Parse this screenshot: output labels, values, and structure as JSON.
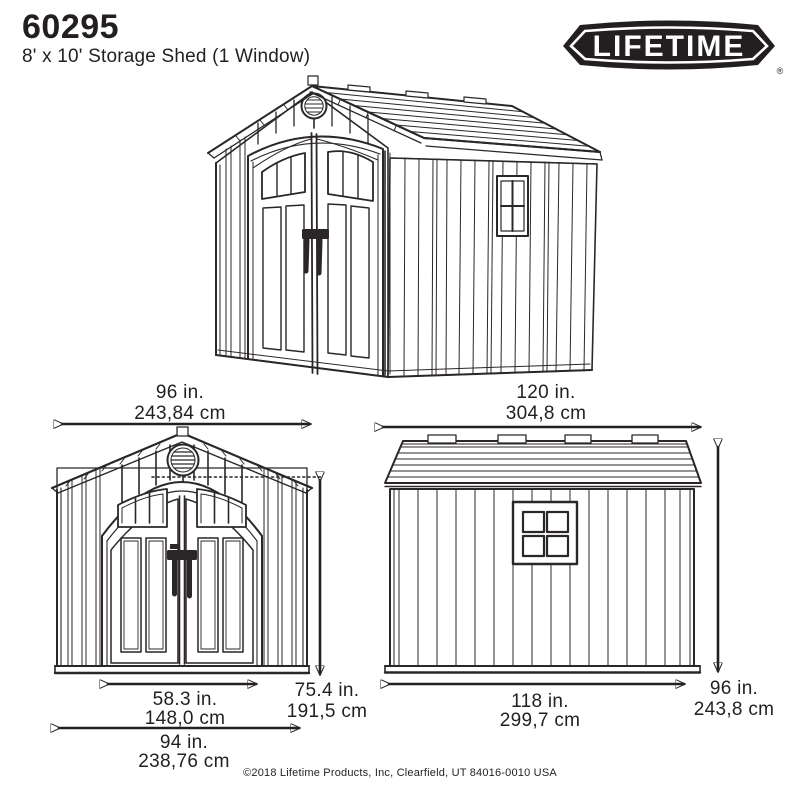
{
  "header": {
    "model": "60295",
    "subtitle": "8' x 10' Storage Shed (1 Window)"
  },
  "logo": {
    "text": "LIFETIME",
    "registered": "®",
    "badge_color": "#231f20",
    "text_color": "#ffffff"
  },
  "dimensions": {
    "front_width": {
      "in": "96 in.",
      "cm": "243,84 cm"
    },
    "side_length": {
      "in": "120 in.",
      "cm": "304,8 cm"
    },
    "door_width": {
      "in": "58.3 in.",
      "cm": "148,0 cm"
    },
    "front_height": {
      "in": "75.4 in.",
      "cm": "191,5 cm"
    },
    "base_width": {
      "in": "94 in.",
      "cm": "238,76 cm"
    },
    "side_base_length": {
      "in": "118 in.",
      "cm": "299,7 cm"
    },
    "side_height": {
      "in": "96 in.",
      "cm": "243,8 cm"
    }
  },
  "footer": {
    "copyright": "©2018 Lifetime Products, Inc, Clearfield, UT 84016-0010 USA"
  },
  "colors": {
    "ink": "#231f20",
    "background": "#ffffff"
  }
}
